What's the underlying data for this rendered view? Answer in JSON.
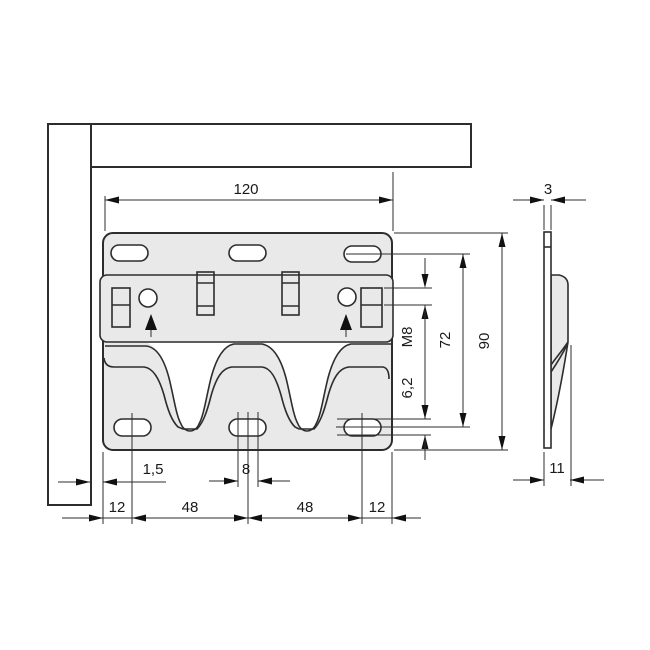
{
  "colors": {
    "background": "#ffffff",
    "part_fill": "#e9e9e9",
    "outline": "#2d2d2d",
    "dimension": "#1a1a1a"
  },
  "front_view": {
    "width": "120",
    "edge_gap": "1,5",
    "slot_width": "8",
    "margin_left": "12",
    "pitch_left": "48",
    "pitch_right": "48",
    "margin_right": "12",
    "thread": "M8",
    "slot_height": "6,2",
    "vertical_spacing": "72",
    "height": "90"
  },
  "side_view": {
    "thickness": "3",
    "depth": "11"
  }
}
